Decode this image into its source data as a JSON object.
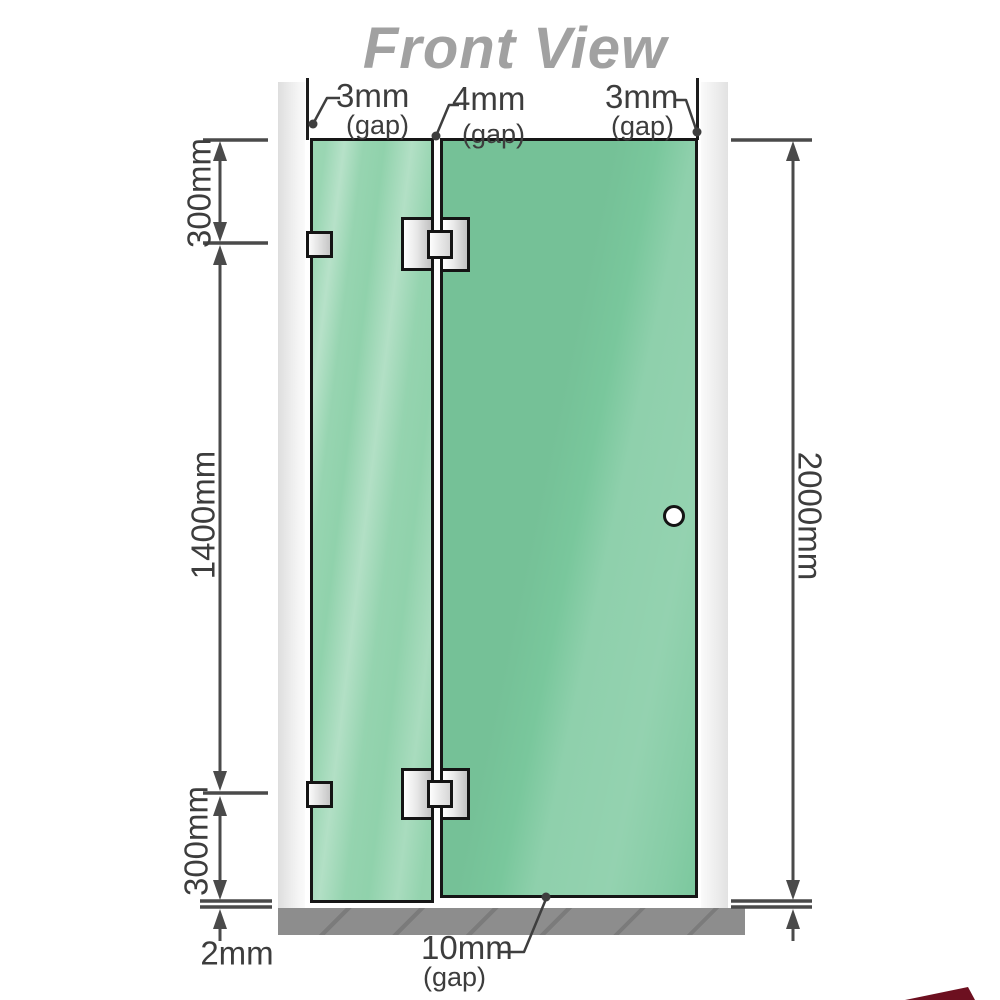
{
  "title": "Front View",
  "diagram": {
    "type": "shower-screen front elevation",
    "parts": {
      "left_wall": "wall channel",
      "right_wall": "wall channel",
      "fixed_panel": "green glass fixed panel",
      "door_panel": "green glass hinged door",
      "floor": "hatched floor strip",
      "knob": "round door knob",
      "hinges": "two glass-to-glass hinges",
      "brackets": "two wall-to-glass brackets"
    }
  },
  "gap_labels": {
    "top_left": {
      "value": "3mm",
      "unit": "(gap)"
    },
    "top_middle": {
      "value": "4mm",
      "unit": "(gap)"
    },
    "top_right": {
      "value": "3mm",
      "unit": "(gap)"
    },
    "bottom": {
      "value": "10mm",
      "unit": "(gap)"
    }
  },
  "dimensions": {
    "left_top": "300mm",
    "left_middle": "1400mm",
    "left_bottom": "300mm",
    "floor_clearance": "2mm",
    "right_total": "2000mm"
  },
  "colors": {
    "glass_green": "#79c79c",
    "glass_green_light": "#a9dec2",
    "wall_gray": "#e7e7e7",
    "floor_gray": "#8d8d8d",
    "line_dark": "#161616",
    "dimension_gray": "#4a4a4a",
    "title_gray": "#a1a1a1",
    "corner_red": "#6d1020"
  }
}
